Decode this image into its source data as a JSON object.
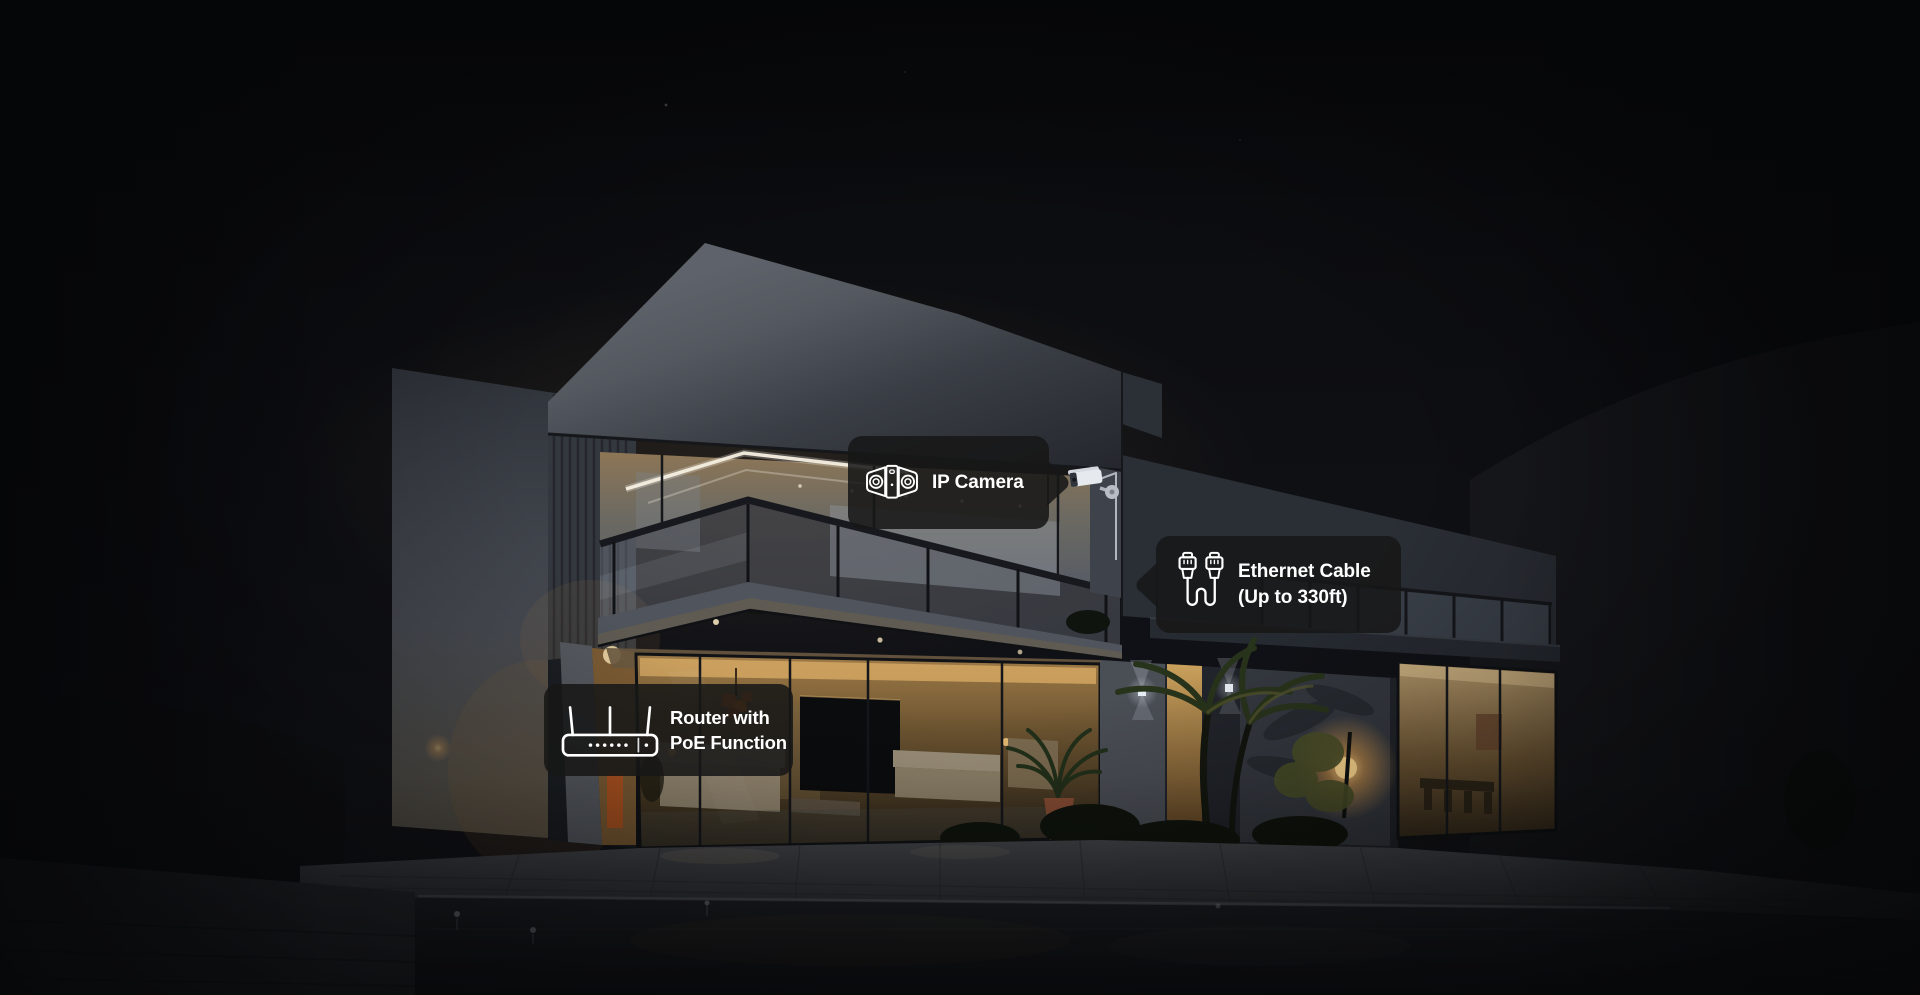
{
  "callouts": [
    {
      "id": "ip-camera",
      "icon": "ip-camera-icon",
      "arrow_direction": "right",
      "lines": [
        "IP Camera"
      ]
    },
    {
      "id": "ethernet-cable",
      "icon": "ethernet-cable-icon",
      "arrow_direction": "left",
      "lines": [
        "Ethernet Cable",
        "(Up to 330ft)"
      ]
    },
    {
      "id": "router-poe",
      "icon": "router-icon",
      "arrow_direction": "none",
      "lines": [
        "Router with",
        "PoE Function"
      ]
    }
  ],
  "colors": {
    "callout_bg": "rgba(23,23,23,0.87)",
    "callout_text": "#ffffff",
    "icon_stroke": "#ffffff",
    "sky_top": "#0a0b0d",
    "sky_bottom": "#15161a",
    "warm_interior": "#c89a55",
    "led_strip": "#f2ecdc",
    "garden_glow": "#f2a94e"
  }
}
